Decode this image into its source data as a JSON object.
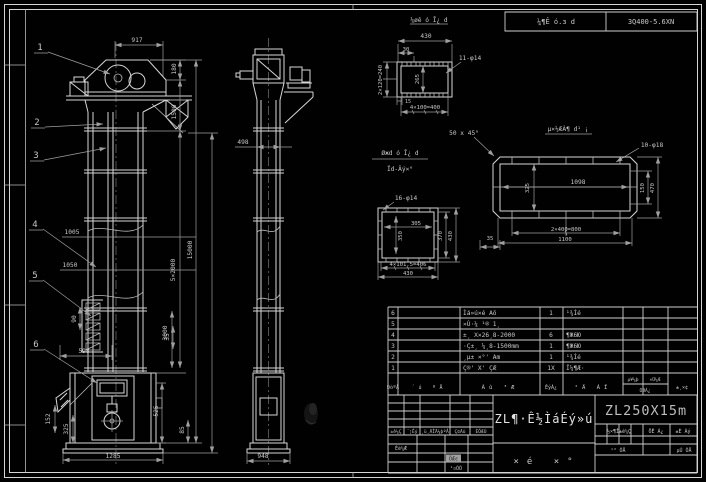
{
  "colors": {
    "bg": "#000000",
    "line": "#d6d6d6",
    "dim": "#9f9f9f",
    "text": "#c8c8c8",
    "highlight": "#a0a0a0"
  },
  "header_bar": {
    "left": "¼¶Ê ó.з d",
    "right": "3Q400-5.6XN"
  },
  "front_view": {
    "labels": [
      "1",
      "2",
      "3",
      "4",
      "5",
      "6"
    ],
    "dims": {
      "d917": "917",
      "d180": "180",
      "d1500": "1500",
      "d5x2000": "5×2000",
      "d3000": "3000",
      "d15000": "15000",
      "d1005": "1005",
      "d1050": "1050",
      "d90": "90",
      "d598": "598",
      "d152": "152",
      "d325": "325",
      "d525": "525",
      "d85": "85",
      "d35": "35",
      "d1285": "1285"
    }
  },
  "side_view": {
    "d498": "498",
    "d948": "948"
  },
  "flange_detail": {
    "title": "¼øê ó Ī¿ d",
    "d430": "430",
    "d30": "30",
    "d2x120": "2×120=240",
    "d265": "265",
    "d15": "15",
    "d4x100": "4×100=400",
    "holes": "11-φ14"
  },
  "base_flange": {
    "title_top": "Øжd ó Ī¿ d",
    "title_bottom": "Ïd-Âý×°",
    "holes": "16-φ14",
    "d305": "305",
    "d350": "350",
    "d370": "370",
    "d430r": "430",
    "d4x101": "4×101.5=406",
    "d430b": "430",
    "d35": "35"
  },
  "duct": {
    "title": "µ×½ÆÀ¶ d¹ ¡",
    "chamfer": "50 x 45°",
    "holes": "10-φ18",
    "d1098": "1098",
    "d325": "325",
    "d150": "150",
    "d470": "470",
    "d2x400": "2×400=800",
    "d1100": "1100"
  },
  "parts": {
    "headers": {
      "seq": "ÐòºÅ",
      "code": "´ú ºÅ",
      "name": "Ãû ³Æ",
      "qty": "ÊýÁ¿",
      "material": "²Ä ÁÏ",
      "w_unit": "µ¥¼þ",
      "w_total": "×Ü¼Æ",
      "weight": "ÖØÁ¿",
      "note": "±¸×¢"
    },
    "rows": [
      {
        "seq": "6",
        "name": "Ìá»ú×é Aö",
        "qty": "1",
        "material": "¹¾Íé"
      },
      {
        "seq": "5",
        "name": "»Ù·¼ ¹® 1¸",
        "qty": "",
        "material": ""
      },
      {
        "seq": "4",
        "name": "±¸ X×26¸8-2000",
        "qty": "6",
        "material": "¶Ж6Ю"
      },
      {
        "seq": "3",
        "name": "·Ç±¸ ¼¸8-1500mm",
        "qty": "1",
        "material": "¶Ж6Ю"
      },
      {
        "seq": "2",
        "name": "¸µ± ×°' Am",
        "qty": "1",
        "material": "¹¾Íé"
      },
      {
        "seq": "1",
        "name": "Ç®' X' ÇÆ",
        "qty": "1X",
        "material": "Î¼¶Æ·"
      }
    ]
  },
  "tb": {
    "rev": [
      "±ê¼Ç",
      "´¦Êý",
      "¸ü¸ÄÎÄ¼þºÅ",
      "Ç©Ãû",
      "ÈÕÆÚ"
    ],
    "design": "Éè¼Æ",
    "highlight": "ÖÆͼ",
    "process": "¹¤ÒÕ",
    "title": "ZL¶·Ê½ÌáÉý»ú",
    "subtitle": "×é ×°",
    "model": "ZL250X15m",
    "stage": "½×¶Î±ê¼Ç",
    "mass": "ÖÊ Á¿",
    "scale": "±È Àý",
    "sheets_total": "¹² ÕÅ",
    "sheet_no": "µÚ ÕÅ"
  }
}
